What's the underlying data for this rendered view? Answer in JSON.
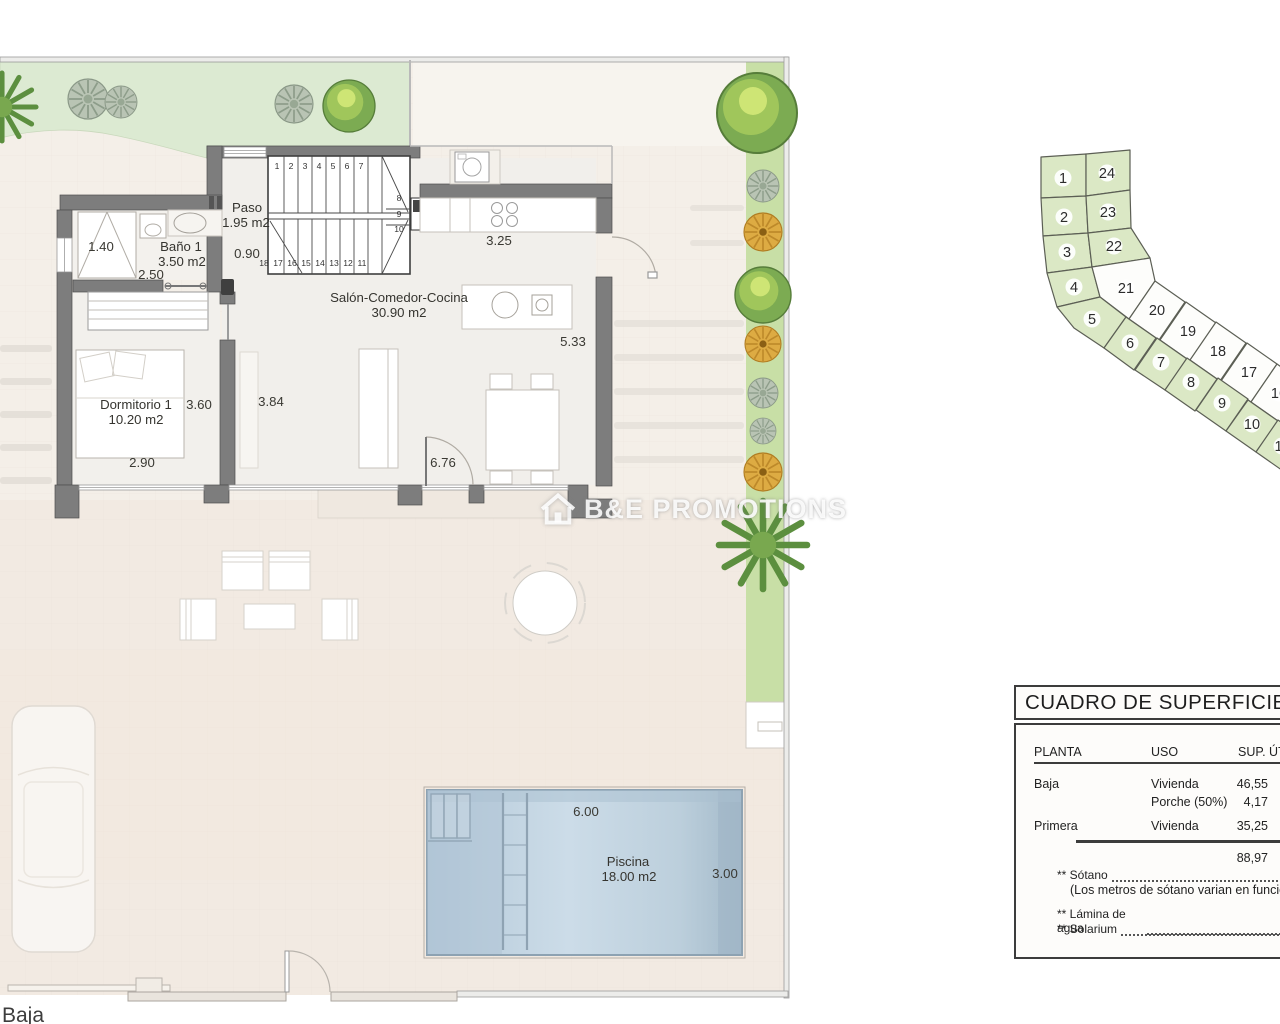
{
  "page": {
    "floor_label": "Baja"
  },
  "watermark": {
    "text": "B&E PROMOTIONS",
    "icon": "house-logo"
  },
  "colors": {
    "garden_green": "#dcead2",
    "lot_green": "#dbe8c5",
    "lot_white": "#fdfdfb",
    "wall_grey": "#7d7d7d",
    "pool_blue": "#bfd3e1",
    "paving": "#f4efe8"
  },
  "floorplan": {
    "rooms": {
      "paso": {
        "name": "Paso",
        "area": "1.95 m2"
      },
      "bano": {
        "name": "Baño 1",
        "area": "3.50 m2"
      },
      "salon": {
        "name": "Salón-Comedor-Cocina",
        "area": "30.90 m2"
      },
      "dormitorio": {
        "name": "Dormitorio 1",
        "area": "10.20 m2"
      },
      "piscina": {
        "name": "Piscina",
        "area": "18.00 m2"
      }
    },
    "dims": {
      "bano_width": "1.40",
      "bano_length": "2.50",
      "paso_width": "0.90",
      "cocina_width": "3.25",
      "salon_depth": "5.33",
      "dorm_width": "3.60",
      "salon_width": "3.84",
      "dorm_length": "2.90",
      "salon_length": "6.76",
      "pool_length": "6.00",
      "pool_width": "3.00"
    },
    "stairs": {
      "top": [
        "1",
        "2",
        "3",
        "4",
        "5",
        "6",
        "7"
      ],
      "right": [
        "8",
        "9",
        "10"
      ],
      "bottom": [
        "18",
        "17",
        "16",
        "15",
        "14",
        "13",
        "12",
        "11"
      ]
    }
  },
  "siteplan": {
    "lots": [
      {
        "number": "1",
        "zone": "green"
      },
      {
        "number": "24",
        "zone": "green"
      },
      {
        "number": "2",
        "zone": "green"
      },
      {
        "number": "23",
        "zone": "green"
      },
      {
        "number": "3",
        "zone": "green"
      },
      {
        "number": "22",
        "zone": "green"
      },
      {
        "number": "4",
        "zone": "green"
      },
      {
        "number": "21",
        "zone": "white"
      },
      {
        "number": "5",
        "zone": "green"
      },
      {
        "number": "20",
        "zone": "white"
      },
      {
        "number": "19",
        "zone": "white"
      },
      {
        "number": "18",
        "zone": "white"
      },
      {
        "number": "17",
        "zone": "white"
      },
      {
        "number": "16",
        "zone": "white"
      },
      {
        "number": "6",
        "zone": "green"
      },
      {
        "number": "7",
        "zone": "green"
      },
      {
        "number": "8",
        "zone": "green"
      },
      {
        "number": "9",
        "zone": "green"
      },
      {
        "number": "10",
        "zone": "green"
      },
      {
        "number": "11",
        "zone": "green"
      }
    ]
  },
  "table": {
    "title": "CUADRO DE SUPERFICIE",
    "col_planta": "PLANTA",
    "col_uso": "USO",
    "col_sup": "SUP. ÚT",
    "rows": [
      {
        "planta": "Baja",
        "uso": "Vivienda",
        "sup": "46,55"
      },
      {
        "planta": "",
        "uso": "Porche (50%)",
        "sup": "4,17"
      },
      {
        "planta": "Primera",
        "uso": "Vivienda",
        "sup": "35,25"
      }
    ],
    "total": "88,97",
    "note_sotano": "** Sótano",
    "note_sotano_detail": "(Los metros de sótano varian en función d",
    "note_lamina": "** Lámina de agua",
    "note_solarium": "** Solarium"
  }
}
